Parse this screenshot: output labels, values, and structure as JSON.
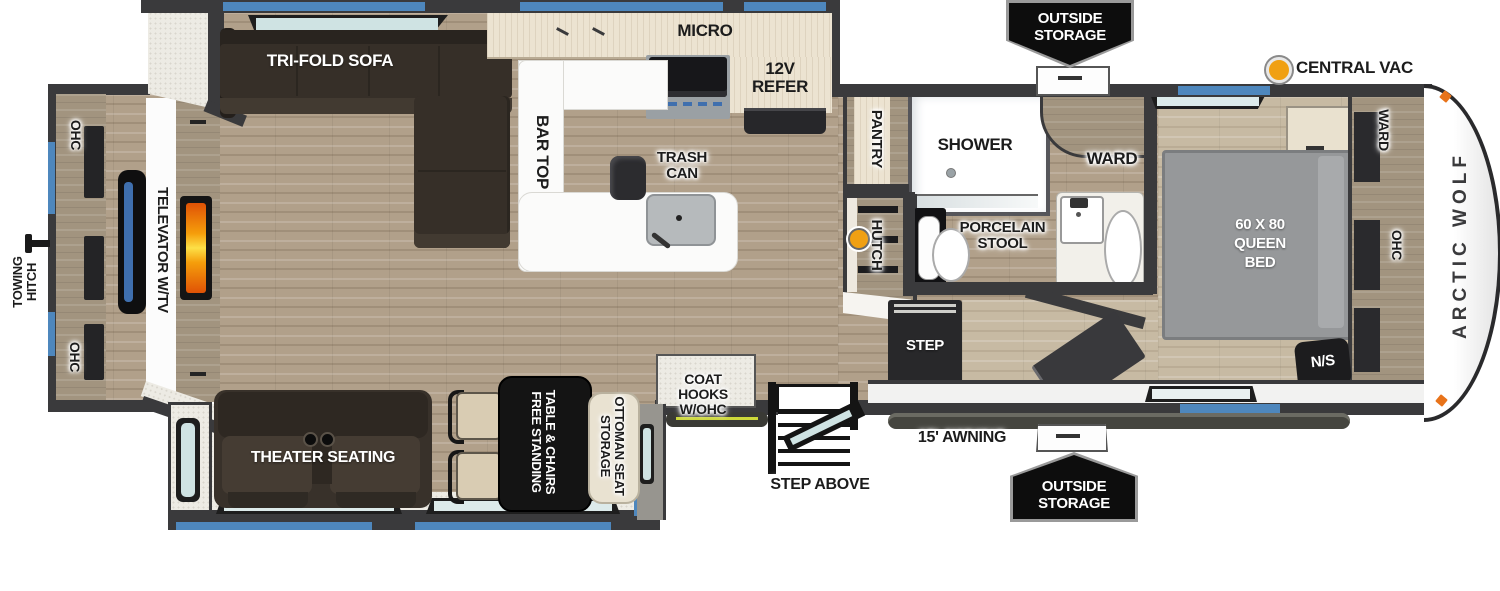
{
  "legend": {
    "central_vac": "CENTRAL VAC",
    "outside_storage_top": [
      "OUTSIDE",
      "STORAGE"
    ],
    "outside_storage_bottom": [
      "OUTSIDE",
      "STORAGE"
    ]
  },
  "front": {
    "towing_hitch": [
      "TOWING",
      "HITCH"
    ],
    "ohc_top": "OHC",
    "ohc_bottom": "OHC",
    "televator": "TELEVATOR W/TV"
  },
  "living": {
    "tri_fold_sofa": "TRI-FOLD SOFA",
    "theater_seating": "THEATER SEATING",
    "dinette": [
      "FREE STANDING",
      "TABLE & CHAIRS"
    ],
    "ottoman": [
      "STORAGE",
      "OTTOMAN SEAT"
    ],
    "coat_hooks": [
      "COAT HOOKS",
      "W/OHC"
    ]
  },
  "kitchen": {
    "micro": "MICRO",
    "refer": [
      "12V",
      "REFER"
    ],
    "bar_top": "BAR TOP",
    "trash": [
      "TRASH",
      "CAN"
    ]
  },
  "bath": {
    "pantry": "PANTRY",
    "shower": "SHOWER",
    "ward": "WARD",
    "hutch": "HUTCH",
    "stool": [
      "PORCELAIN",
      "STOOL"
    ],
    "step": "STEP"
  },
  "bedroom": {
    "bed": [
      "60 X 80",
      "QUEEN",
      "BED"
    ],
    "ward": "WARD",
    "ohc": "OHC",
    "ns": "N/S"
  },
  "exterior": {
    "awning": "15' AWNING",
    "step_above": "STEP ABOVE",
    "brand": "ARCTIC WOLF"
  },
  "colors": {
    "accent_blue": "#4e87bd",
    "wall_dark": "#3a3a3c",
    "fireplace_orange": "#f97316",
    "vac_orange": "#f0a013",
    "led_yellow": "#cdd83a"
  }
}
